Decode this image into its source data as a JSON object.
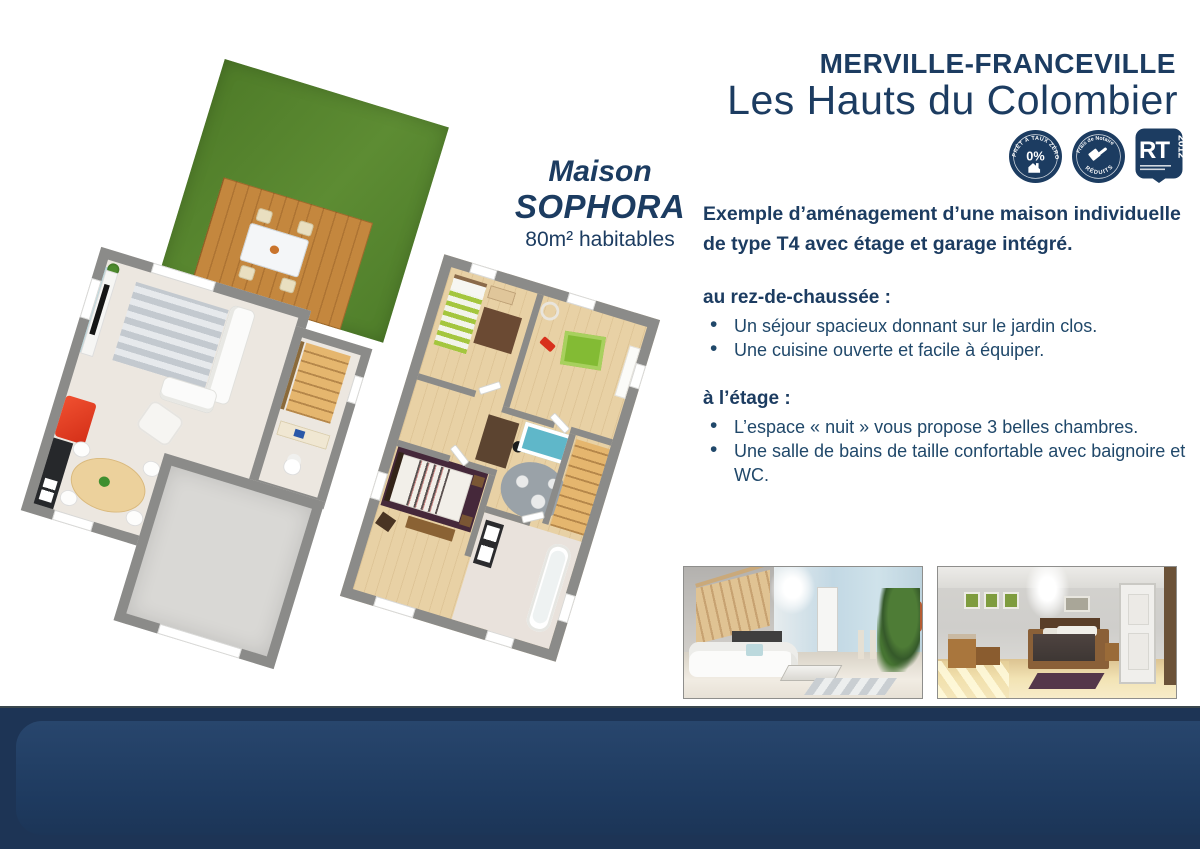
{
  "palette": {
    "navy": "#1c3c61",
    "text": "#20486a",
    "band": "#1d3455",
    "band_inner": "#28466d",
    "grass": "#54822d",
    "deck": "#c4873e",
    "wall": "#8b8b89",
    "floor": "#ece7e0",
    "garage": "#d9d8d5",
    "wood": "#e8d1a5",
    "stair": "#e5b66e",
    "red": "#e8402a"
  },
  "header": {
    "location": "MERVILLE-FRANCEVILLE",
    "program": "Les Hauts du Colombier",
    "badges": [
      {
        "icon": "pret-a-taux-zero-badge",
        "arc_top": "PRÊT À TAUX ZÉRO",
        "center": "0%"
      },
      {
        "icon": "frais-de-notaire-badge",
        "arc_top": "Frais de Notaire",
        "arc_bottom": "RÉDUITS"
      },
      {
        "icon": "rt-2012-badge",
        "main": "RT",
        "year": "2012"
      }
    ]
  },
  "plan_label": {
    "line1": "Maison",
    "line2": "SOPHORA",
    "surface": "80m² habitables"
  },
  "description": {
    "intro_lines": [
      "Exemple d’aménagement d’une maison individuelle",
      "de type T4 avec étage et garage intégré."
    ],
    "sections": [
      {
        "title": "au rez-de-chaussée :",
        "bullets": [
          "Un séjour spacieux donnant sur le jardin clos.",
          "Une cuisine ouverte et facile à équiper."
        ]
      },
      {
        "title": "à l’étage :",
        "bullets": [
          "L’espace « nuit » vous propose 3 belles chambres.",
          "Une salle de bains de taille confortable avec baignoire et WC."
        ]
      }
    ]
  },
  "floor_plans": {
    "ground_name": "rez-de-chaussée",
    "upper_name": "étage"
  },
  "photos": [
    {
      "icon": "living-room-photo"
    },
    {
      "icon": "bedroom-photo"
    }
  ]
}
